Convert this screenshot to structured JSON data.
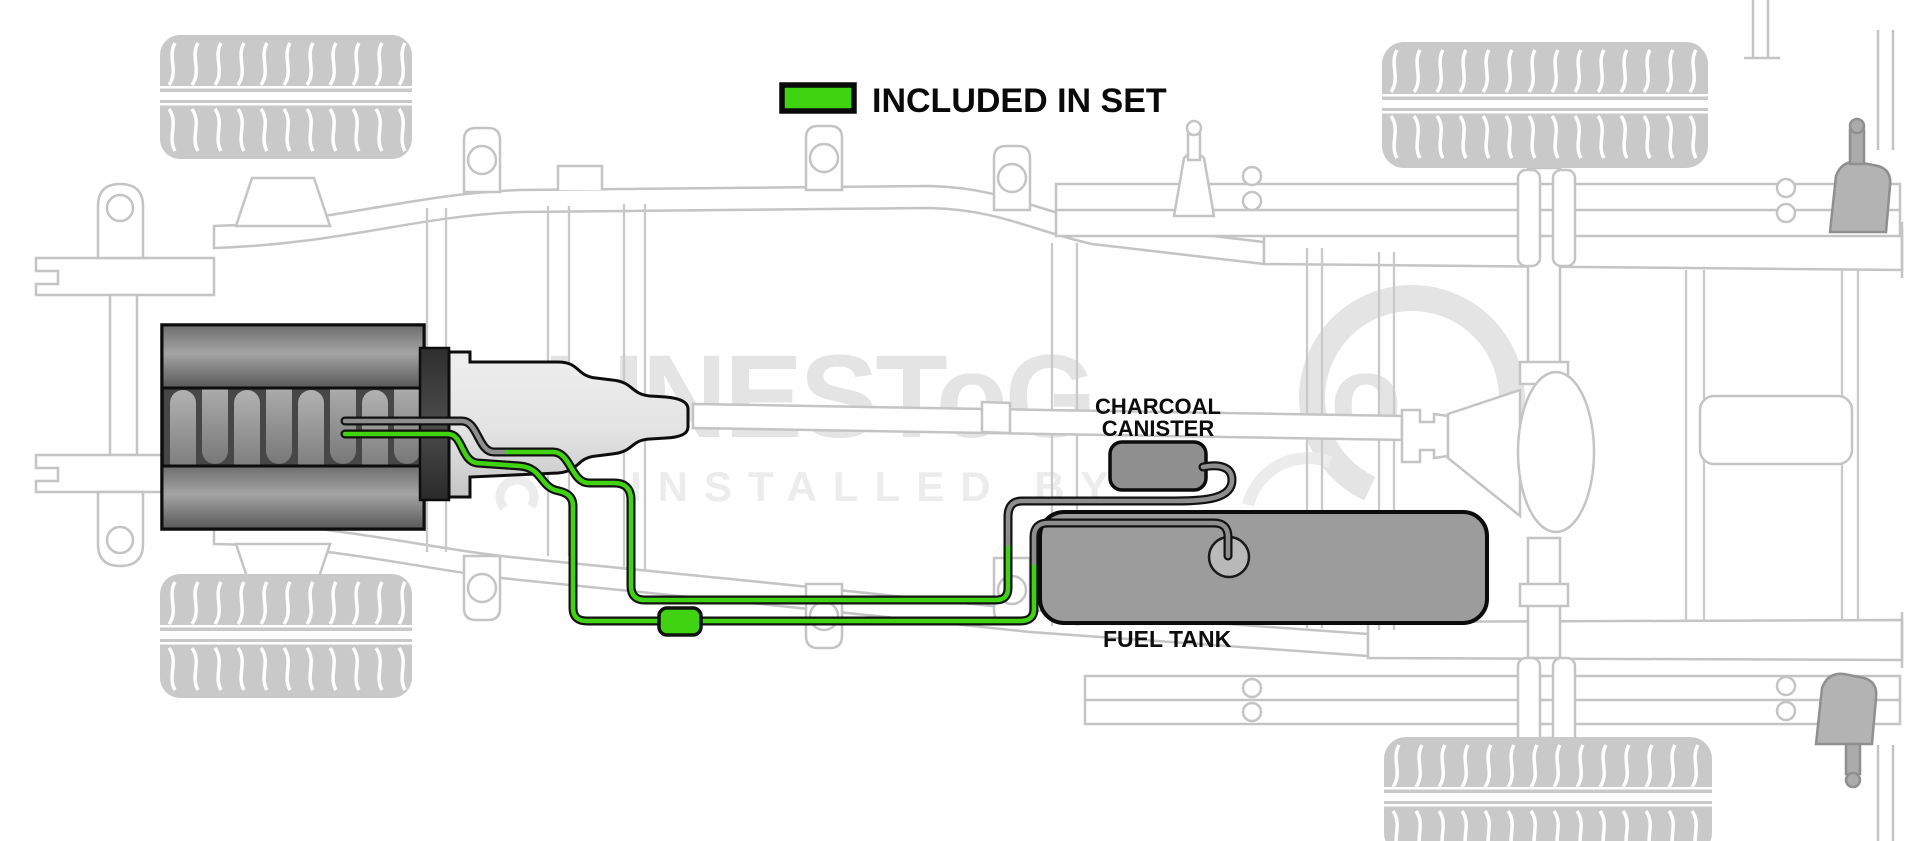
{
  "legend": {
    "label": "INCLUDED IN SET",
    "swatch_color": "#3fd312"
  },
  "component_labels": {
    "charcoal_canister_line1": "CHARCOAL",
    "charcoal_canister_line2": "CANISTER",
    "fuel_tank": "FUEL TANK"
  },
  "watermark": {
    "brand": "LINESToG",
    "brand_suffix": "o",
    "tagline": "INSTALLED BY"
  },
  "colors": {
    "included_green": "#3fd312",
    "line_gray": "#8e8e8e",
    "tank_gray": "#9c9c9c",
    "canister_gray": "#8f8f8f",
    "sender_gray": "#b9b9b9",
    "chassis_gray": "#c4c4c4",
    "tire_gray": "#c9c9c9",
    "watermark_gray": "#e4e4e4",
    "outline_black": "#111111"
  }
}
